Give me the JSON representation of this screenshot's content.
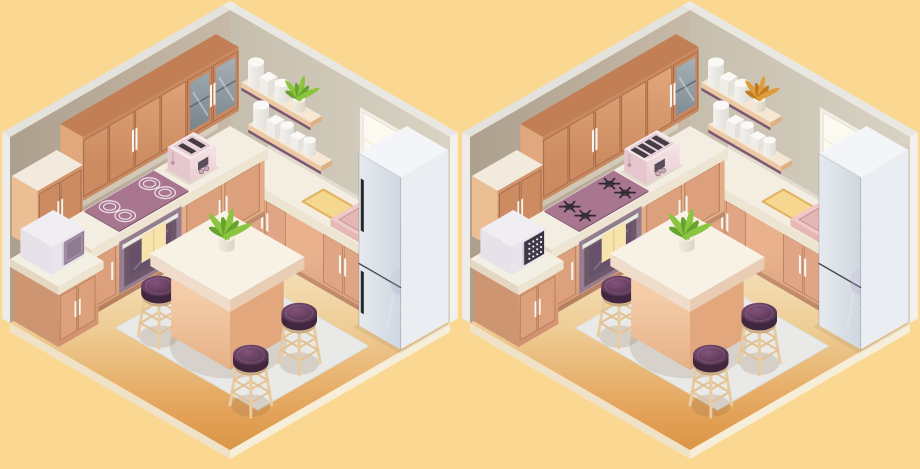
{
  "palette": {
    "background": "#FBD892",
    "wall_left": "#B9AB99",
    "wall_right": "#CFC8B7",
    "wall_trim": "#E8E6E1",
    "floor_light": "#F8EFD9",
    "floor_dark": "#D8913F",
    "cabinet_wood": "#D2936C",
    "cabinet_wood_dark": "#A86C4B",
    "countertop": "#F3EEE1",
    "cooktop_surface": "#99667E",
    "glass_pane": "#7E8A92",
    "oven_body": "#6E5769",
    "oven_towel": "#F7E3AC",
    "microwave_body": "#E9E4EC",
    "microwave_door_plain": "#A18DA3",
    "microwave_door_pattern": "#3F3847",
    "toaster_pink": "#F0D6DA",
    "shelf_wood": "#ECC9A4",
    "shelf_trim_purple": "#7C5873",
    "window_glow": "#FFFBE3",
    "sink_pink": "#EFC9C7",
    "fridge_gray": "#DFE4EA",
    "island_top": "#F8F2E6",
    "island_base": "#EFC09E",
    "stool_cushion": "#5E3B59",
    "stool_wood": "#E9CBA2",
    "rug_gray": "#E9EAE7",
    "jar_white": "#FAF9F6",
    "cutting_board": "#F6D78F",
    "plant_green": [
      "#8BC53F",
      "#66A32C"
    ],
    "plant_orange": [
      "#E09B3A",
      "#BF7A1F"
    ]
  },
  "panels": [
    {
      "id": "kitchen-left",
      "variant": {
        "shelf_plant": "green",
        "glass_doors": 2,
        "toaster_slots": 2,
        "cooktop": "electric",
        "microwave_front": "plain",
        "sink_drain": false,
        "fridge_handles": true
      }
    },
    {
      "id": "kitchen-right",
      "variant": {
        "shelf_plant": "orange",
        "glass_doors": 1,
        "toaster_slots": 4,
        "cooktop": "gas",
        "microwave_front": "patterned",
        "sink_drain": true,
        "fridge_handles": false
      }
    }
  ],
  "differences": [
    {
      "object": "shelf-plant",
      "left": "green leaves",
      "right": "orange leaves"
    },
    {
      "object": "upper-cabinets",
      "left": "two glass doors",
      "right": "one glass door"
    },
    {
      "object": "toaster",
      "left": "small two-slot toaster",
      "right": "wide four-slot toaster"
    },
    {
      "object": "cooktop",
      "left": "electric rings",
      "right": "gas burners"
    },
    {
      "object": "microwave",
      "left": "plain door",
      "right": "patterned door"
    },
    {
      "object": "sink",
      "left": "no drain",
      "right": "drain visible"
    },
    {
      "object": "fridge",
      "left": "door handles",
      "right": "no door handles"
    }
  ]
}
